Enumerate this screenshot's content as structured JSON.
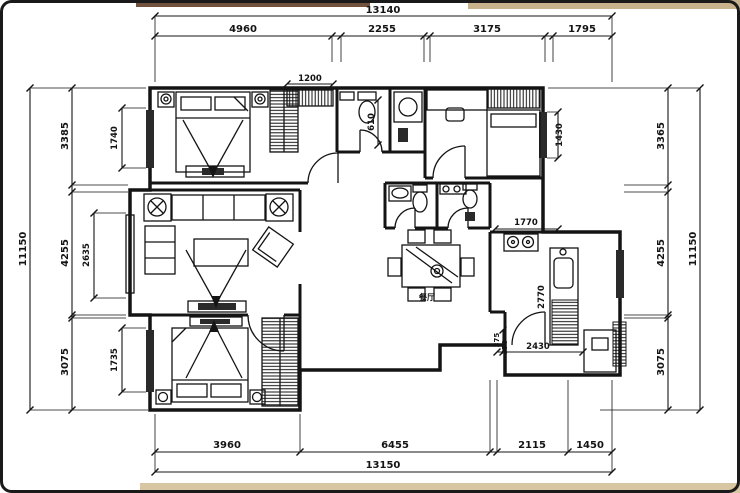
{
  "drawing": {
    "type": "floor-plan",
    "room_labels": {
      "dining": "餐厅"
    },
    "dims": {
      "top": {
        "total": "13140",
        "segments": [
          "4960",
          "2255",
          "3175",
          "1795"
        ]
      },
      "bottom": {
        "total": "13150",
        "segments": [
          "3960",
          "6455",
          "2115",
          "1450"
        ]
      },
      "left": {
        "total": "11150",
        "segments": [
          "3385",
          "4255",
          "3075"
        ],
        "inner": [
          "1740",
          "2635",
          "1735"
        ]
      },
      "right": {
        "total": "11150",
        "segments": [
          "3365",
          "4255",
          "3075"
        ]
      },
      "interior": {
        "closet_width": "1200",
        "bath_width": "610",
        "bedroom2_window": "1430",
        "kitchen_opening": "1770",
        "balcony_depth": "2770",
        "balcony_width": "2430",
        "step_a": "375",
        "step_b": "370"
      }
    },
    "colors": {
      "line": "#141414",
      "paper": "#ffffff",
      "window_fill": "#2a2a2a",
      "desk_top_left": "#70523e",
      "desk_top_right": "#c7b28c",
      "desk_bottom": "#d8c6a2"
    }
  }
}
